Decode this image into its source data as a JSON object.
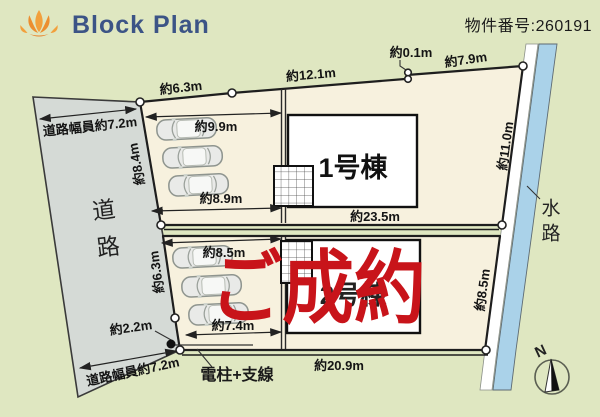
{
  "header": {
    "brand": "Block Plan",
    "property_number": "物件番号:260191"
  },
  "plan": {
    "road": {
      "label": "道路",
      "width_label_top": "道路幅員約7.2m",
      "width_label_bottom": "道路幅員約7.2m"
    },
    "waterway": {
      "label": "水路"
    },
    "buildings": {
      "b1": "1号棟",
      "b2": "2号棟"
    },
    "stamp": {
      "label": "ご成約",
      "color": "#c8141a"
    },
    "pole": {
      "label": "電柱+支線"
    },
    "compass": {
      "label": "N"
    },
    "dimensions": {
      "top_left": "約6.3m",
      "top_mid": "約12.1m",
      "top_jog": "約0.1m",
      "top_right": "約7.9m",
      "left_upper": "約8.4m",
      "left_lower": "約6.3m",
      "left_bottom": "約2.2m",
      "right_upper": "約11.0m",
      "right_lower": "約8.5m",
      "lot1_front": "約9.9m",
      "lot1_back": "約8.9m",
      "lot1_depth": "約23.5m",
      "lot2_front": "約8.5m",
      "lot2_back": "約7.4m",
      "lot2_depth": "約20.9m"
    }
  },
  "colors": {
    "background": "#dfe7c1",
    "road": "#d5dad6",
    "lot": "#f7f1de",
    "building": "#ffffff",
    "water": "#aad2e9",
    "stamp_red": "#c8141a",
    "brand_navy": "#3c5486",
    "logo_orange": "#ef9a3a"
  }
}
